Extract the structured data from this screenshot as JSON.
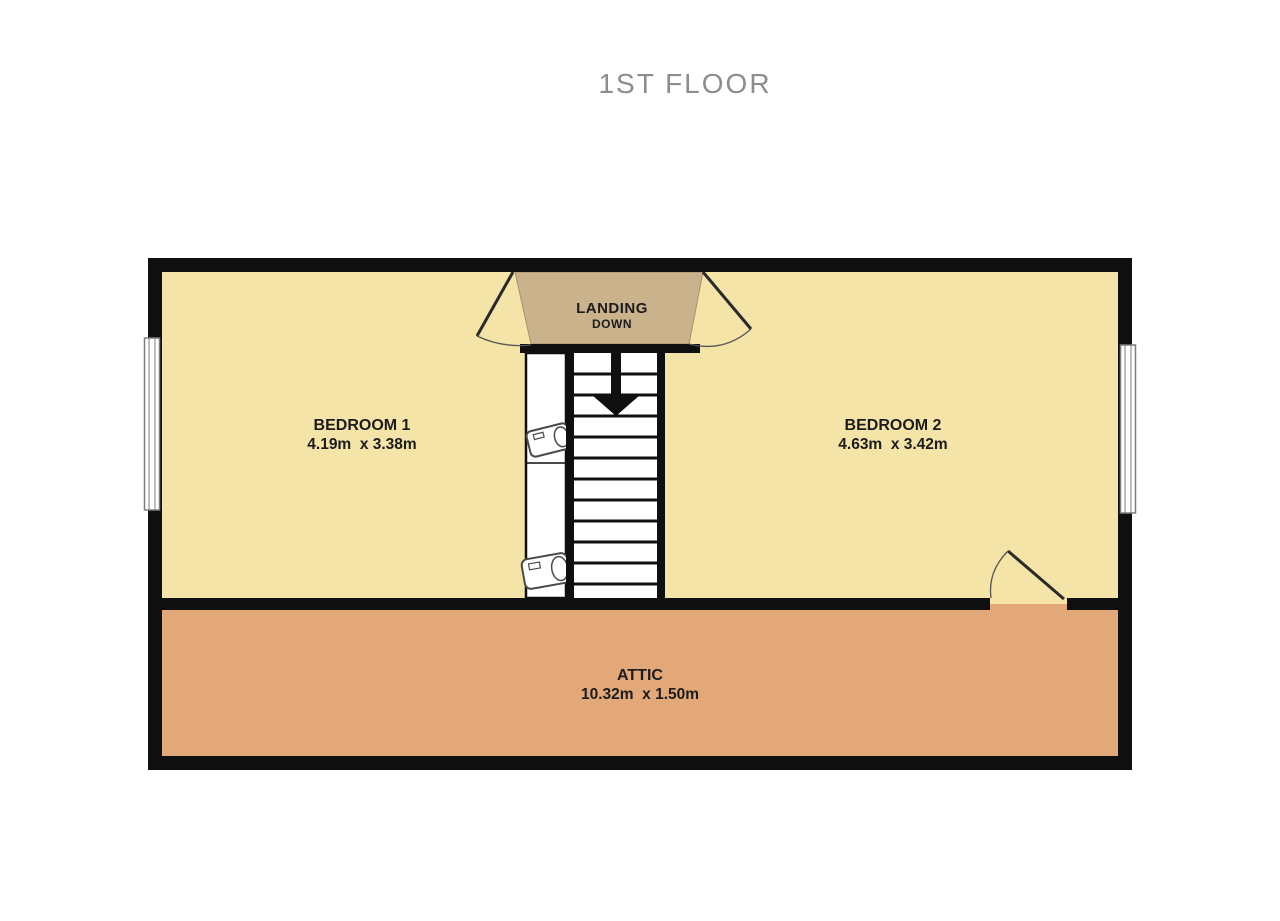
{
  "title": "1ST FLOOR",
  "rooms": {
    "bedroom1": {
      "name": "BEDROOM 1",
      "dimensions": "4.19m  x 3.38m"
    },
    "bedroom2": {
      "name": "BEDROOM 2",
      "dimensions": "4.63m  x 3.42m"
    },
    "attic": {
      "name": "ATTIC",
      "dimensions": "10.32m  x 1.50m"
    },
    "landing": {
      "name": "LANDING",
      "direction": "DOWN"
    }
  },
  "icons": {
    "stairs_arrow": "down-arrow",
    "closet_items": "water-cylinder"
  },
  "colors": {
    "bedroom_fill": "#f4e4a7",
    "attic_fill": "#e2a878",
    "landing_fill": "#c9b28c",
    "wall": "#0f0f0f",
    "title_text": "#8d8d8d",
    "label_text": "#1c1c1c",
    "window_frame": "#7d7d7d"
  }
}
